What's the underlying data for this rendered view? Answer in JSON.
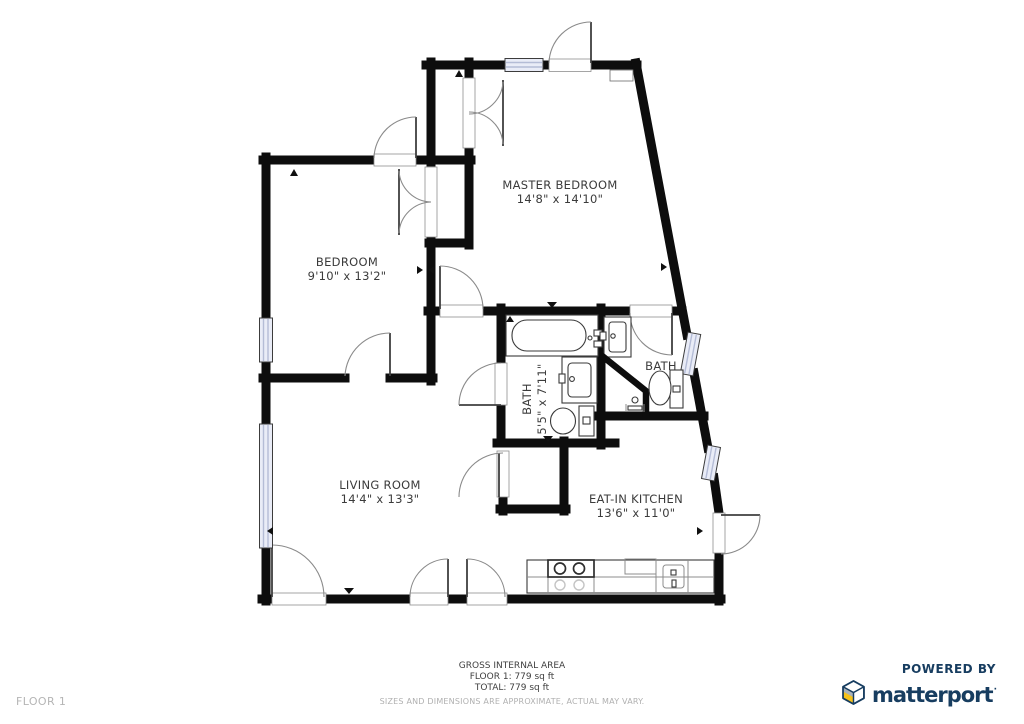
{
  "rooms": {
    "master_bedroom": {
      "label": "MASTER BEDROOM",
      "dims": "14'8\" x 14'10\""
    },
    "bedroom": {
      "label": "BEDROOM",
      "dims": "9'10\" x 13'2\""
    },
    "bath_main": {
      "label": "BATH",
      "dims": "5'5\" x 7'11\""
    },
    "bath_ensuite": {
      "label": "BATH"
    },
    "living_room": {
      "label": "LIVING ROOM",
      "dims": "14'4\" x 13'3\""
    },
    "kitchen": {
      "label": "EAT-IN KITCHEN",
      "dims": "13'6\" x 11'0\""
    }
  },
  "footer": {
    "floor_label": "FLOOR 1",
    "gross_line1": "GROSS INTERNAL AREA",
    "gross_line2": "FLOOR 1: 779 sq ft",
    "gross_line3": "TOTAL: 779 sq ft",
    "disclaimer": "SIZES AND DIMENSIONS ARE APPROXIMATE, ACTUAL MAY VARY."
  },
  "branding": {
    "powered_by": "POWERED BY",
    "brand": "matterport",
    "brand_color": "#173d60",
    "cube_yellow": "#f6c21a",
    "cube_gray": "#a9b2ba"
  }
}
